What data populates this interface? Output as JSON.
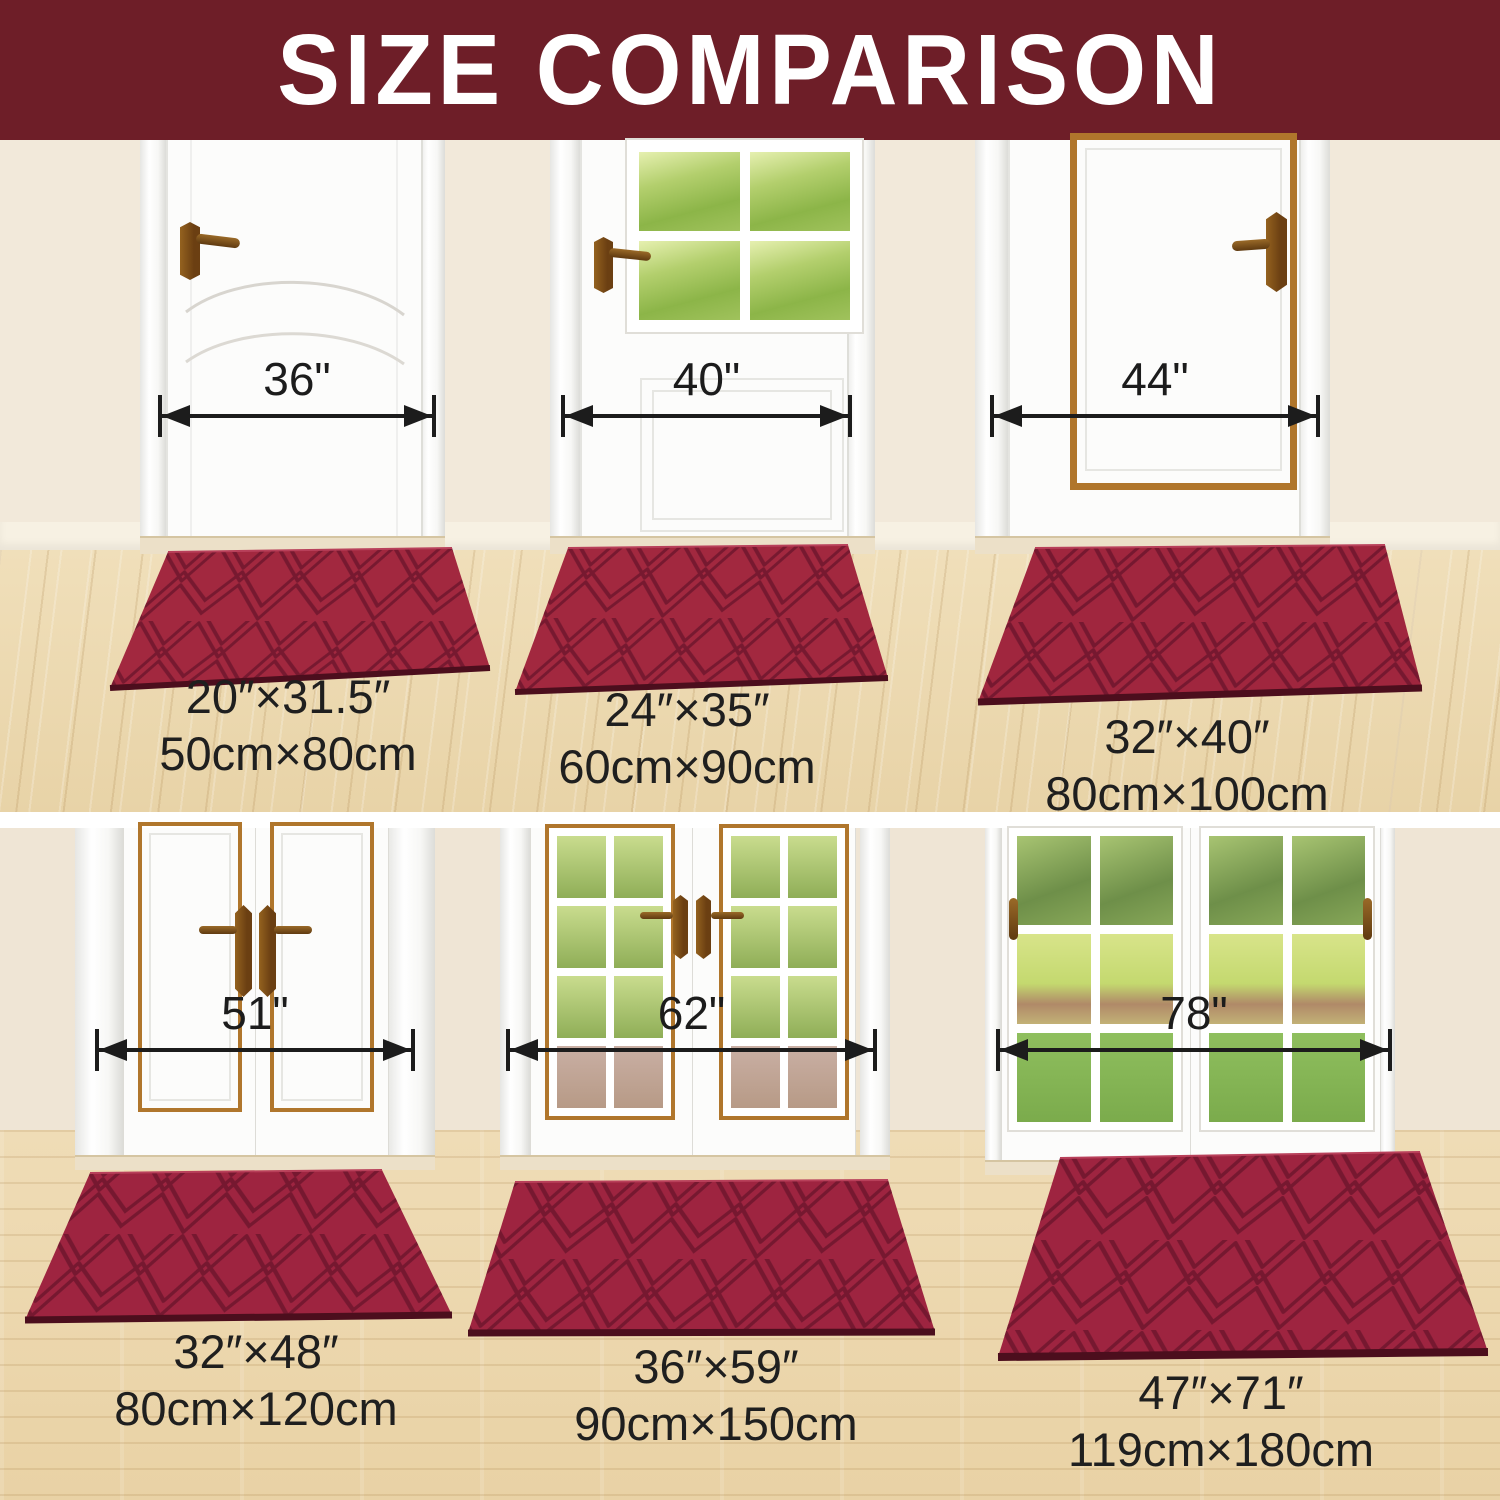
{
  "title": "SIZE COMPARISON",
  "colors": {
    "banner_bg": "#6e1e28",
    "banner_text": "#ffffff",
    "mat_red": "#a2283f",
    "mat_groove": "#6a142b",
    "measure_text": "#1c1c1c",
    "wall": "#f2e9da",
    "floor_wood": "#ecd9b2",
    "door_trim_gold": "#b0762c"
  },
  "top_row": {
    "doors": [
      {
        "measurement": "36\""
      },
      {
        "measurement": "40\""
      },
      {
        "measurement": "44\""
      }
    ],
    "mats": [
      {
        "inches": "20″×31.5″",
        "cm": "50cm×80cm"
      },
      {
        "inches": "24″×35″",
        "cm": "60cm×90cm"
      },
      {
        "inches": "32″×40″",
        "cm": "80cm×100cm"
      }
    ]
  },
  "bottom_row": {
    "doors": [
      {
        "measurement": "51\""
      },
      {
        "measurement": "62\""
      },
      {
        "measurement": "78\""
      }
    ],
    "mats": [
      {
        "inches": "32″×48″",
        "cm": "80cm×120cm"
      },
      {
        "inches": "36″×59″",
        "cm": "90cm×150cm"
      },
      {
        "inches": "47″×71″",
        "cm": "119cm×180cm"
      }
    ]
  }
}
